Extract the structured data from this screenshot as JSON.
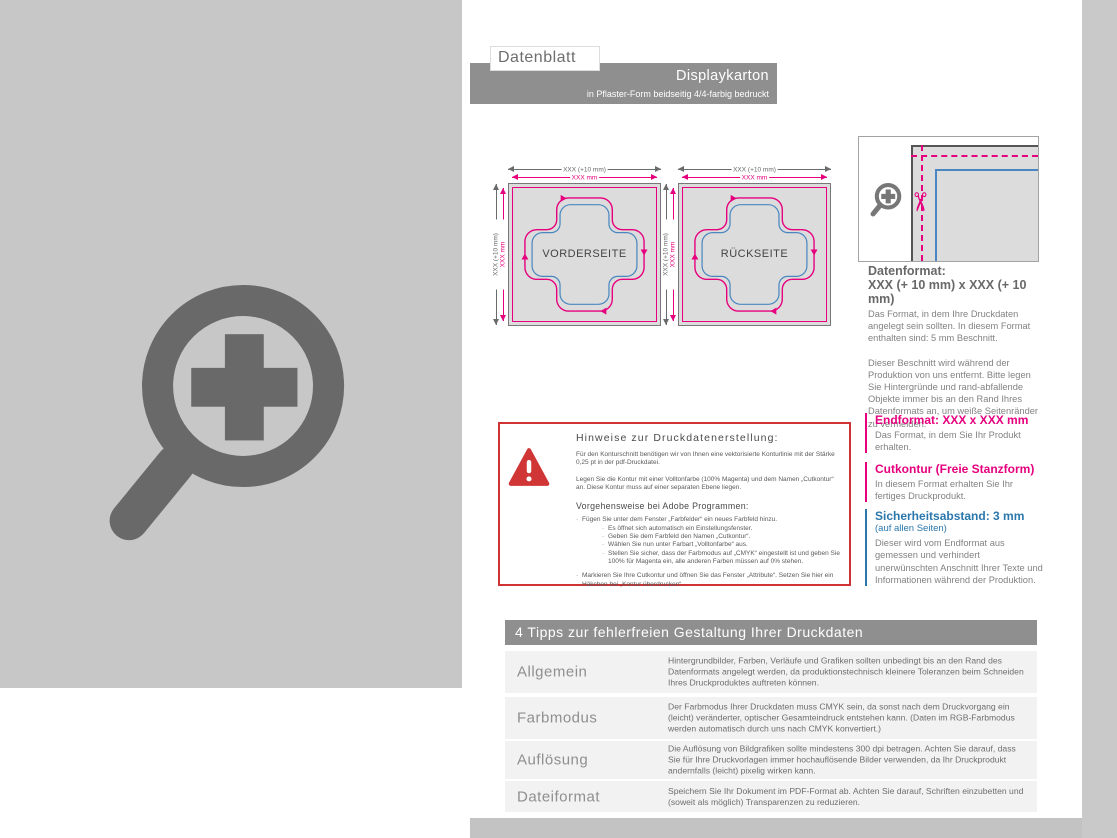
{
  "header": {
    "doc_label": "Datenblatt",
    "title": "Displaykarton",
    "subtitle": "in Pflaster-Form beidseitig 4/4-farbig bedruckt"
  },
  "diagrams": {
    "front_label": "VORDERSEITE",
    "back_label": "RÜCKSEITE",
    "dim_outer": "XXX (+10 mm)",
    "dim_inner": "XXX mm"
  },
  "info": {
    "datenformat_heading": "Datenformat:",
    "datenformat_size": "XXX (+ 10 mm) x XXX (+ 10 mm)",
    "datenformat_body1": "Das Format, in dem Ihre Druckdaten angelegt sein sollten. In diesem Format enthalten sind: 5 mm Beschnitt.",
    "datenformat_body2": "Dieser Beschnitt wird während der Produktion von uns entfernt. Bitte legen Sie Hintergründe und rand-abfallende Objekte immer bis an den Rand Ihres Datenformats an, um weiße Seitenränder zu vermeiden.",
    "endformat_heading": "Endformat: XXX x XXX mm",
    "endformat_body": "Das Format, in dem Sie Ihr Produkt erhalten.",
    "cutkontur_heading": "Cutkontur (Freie Stanzform)",
    "cutkontur_body": "In diesem Format erhalten Sie Ihr fertiges Druckprodukt.",
    "sicherheit_heading": "Sicherheitsabstand: 3 mm",
    "sicherheit_sub": "(auf allen Seiten)",
    "sicherheit_body": "Dieser wird vom Endformat aus gemessen und verhindert unerwünschten Anschnitt Ihrer Texte und Informationen während der Produktion."
  },
  "hinweise": {
    "title": "Hinweise zur Druckdatenerstellung:",
    "para1": "Für den Konturschnitt benötigen wir von Ihnen eine vektorisierte Konturlinie mit der Stärke 0,25 pt in der pdf-Druckdatei.",
    "para2": "Legen Sie die Kontur mit einer Volltonfarbe (100% Magenta) und dem Namen „Cutkontur“ an. Diese Kontur muss auf einer separaten Ebene liegen.",
    "subtitle": "Vorgehensweise bei Adobe Programmen:",
    "bullets": [
      {
        "indent": 0,
        "text": "Fügen Sie unter dem Fenster „Farbfelder“ ein neues Farbfeld hinzu."
      },
      {
        "indent": 1,
        "text": "Es öffnet sich automatisch ein Einstellungsfenster."
      },
      {
        "indent": 1,
        "text": "Geben Sie dem Farbfeld den Namen „Cutkontur“."
      },
      {
        "indent": 1,
        "text": "Wählen Sie nun unter Farbart „Volltonfarbe“ aus."
      },
      {
        "indent": 1,
        "text": "Stellen Sie sicher, dass der Farbmodus auf „CMYK“ eingestellt ist und geben Sie 100% für Magenta ein, alle anderen Farben müssen auf 0% stehen."
      },
      {
        "indent": 0,
        "text": "Markieren Sie Ihre Cutkontur und öffnen Sie das Fenster „Attribute“. Setzen Sie hier ein Häkchen bei „Kontur überdrucken“."
      }
    ]
  },
  "tips": {
    "header": "4 Tipps zur fehlerfreien Gestaltung Ihrer Druckdaten",
    "rows": [
      {
        "label": "Allgemein",
        "text": "Hintergrundbilder, Farben, Verläufe und Grafiken sollten unbedingt bis an den Rand des Datenformats angelegt werden, da produktionstechnisch kleinere Toleranzen beim Schneiden Ihres Druckproduktes auftreten können."
      },
      {
        "label": "Farbmodus",
        "text": "Der Farbmodus Ihrer Druckdaten muss CMYK sein, da sonst nach dem Druckvorgang ein (leicht) veränderter, optischer Gesamteindruck entstehen kann. (Daten im RGB-Farbmodus werden automatisch durch uns nach CMYK konvertiert.)"
      },
      {
        "label": "Auflösung",
        "text": "Die Auflösung von Bildgrafiken sollte mindestens 300 dpi betragen. Achten Sie darauf, dass Sie für Ihre Druckvorlagen immer hochauflösende Bilder verwenden, da Ihr Druckprodukt andernfalls (leicht) pixelig wirken kann."
      },
      {
        "label": "Dateiformat",
        "text": "Speichern Sie Ihr Dokument im PDF-Format ab. Achten Sie darauf, Schriften einzubetten und (soweit als möglich) Transparenzen zu reduzieren."
      }
    ]
  },
  "icons": {
    "scissors": "✂",
    "big_magnifier": "zoom-plus-icon",
    "small_magnifier": "zoom-plus-icon",
    "warning": "warning-triangle-icon"
  },
  "colors": {
    "magenta": "#e6007e",
    "contour_blue": "#4a87c0",
    "heading_blue": "#2a77ad",
    "panel_gray": "#c7c7c7",
    "bar_gray": "#8f8f8f",
    "red_border": "#cf3333",
    "row_bg": "#f2f2f2",
    "footer_gray": "#c3c3c3",
    "icon_gray": "#696969"
  }
}
